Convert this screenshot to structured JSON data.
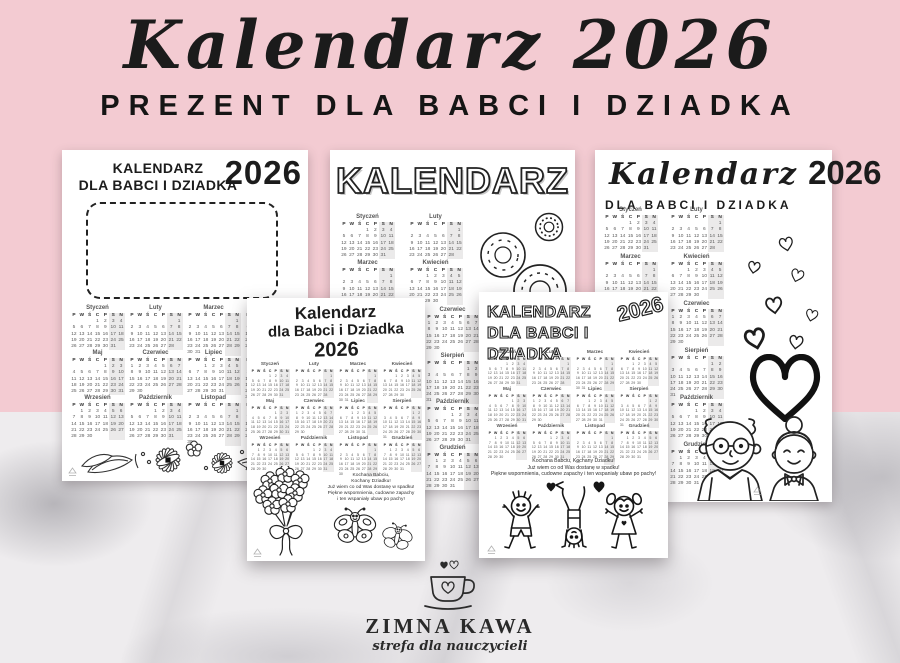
{
  "header": {
    "title": "Kalendarz 2026",
    "subtitle": "PREZENT DLA BABCI I DZIADKA"
  },
  "colors": {
    "pink": "#f3cbd2",
    "ink": "#1c1c1c",
    "weekend_shade": "#ebeaea",
    "marble": "#eeecee"
  },
  "calendar": {
    "year": "2026",
    "day_headers": [
      "P",
      "W",
      "Ś",
      "C",
      "P",
      "S",
      "N"
    ],
    "months": [
      {
        "name": "Styczeń",
        "start": 3,
        "days": 31
      },
      {
        "name": "Luty",
        "start": 6,
        "days": 28
      },
      {
        "name": "Marzec",
        "start": 6,
        "days": 31
      },
      {
        "name": "Kwiecień",
        "start": 2,
        "days": 30
      },
      {
        "name": "Maj",
        "start": 4,
        "days": 31
      },
      {
        "name": "Czerwiec",
        "start": 0,
        "days": 30
      },
      {
        "name": "Lipiec",
        "start": 2,
        "days": 31
      },
      {
        "name": "Sierpień",
        "start": 5,
        "days": 31
      },
      {
        "name": "Wrzesień",
        "start": 1,
        "days": 30
      },
      {
        "name": "Październik",
        "start": 3,
        "days": 31
      },
      {
        "name": "Listopad",
        "start": 6,
        "days": 30
      },
      {
        "name": "Grudzień",
        "start": 1,
        "days": 31
      }
    ]
  },
  "pages": {
    "page1": {
      "title_line1": "KALENDARZ",
      "title_line2": "DLA BABCI I DZIADKA",
      "year": "2026"
    },
    "page2": {
      "title": "KALENDARZ"
    },
    "page3": {
      "title_line1": "Kalendarz",
      "title_line2": "dla Babci i Dziadka",
      "year": "2026",
      "poem": [
        "Kochana Babciu,",
        "Kochany Dziadku!",
        "Już wiem co od Was dostanę w spadku!",
        "Piękne wspomnienia, cudowne zapachy",
        "i ten wspaniały ubaw po pachy!"
      ]
    },
    "page4": {
      "title_line1": "KALENDARZ",
      "title_line2": "DLA BABCI I DZIADKA",
      "year": "2026",
      "poem": [
        "Kochana Babciu, Kochany Dziadku!",
        "Już wiem co od Was dostanę w spadku!",
        "Piękne wspomnienia, cudowne zapachy i ten wspaniały ubaw po pachy!"
      ]
    },
    "page5": {
      "title_script": "Kalendarz",
      "year": "2026",
      "subtitle": "DLA BABCI I DZIADKA"
    }
  },
  "footer": {
    "brand": "ZIMNA KAWA",
    "tagline": "strefa dla nauczycieli"
  },
  "icons": {
    "flower_border": "flower-border-illustration",
    "donuts": "donuts-illustration",
    "bouquet": "flower-bouquet-illustration",
    "butterflies": "butterflies-illustration",
    "kids": "playing-kids-illustration",
    "hearts": "hearts-illustration",
    "big_heart": "big-heart-icon",
    "grandparents": "grandparents-illustration",
    "cup": "coffee-cup-heart-logo-icon",
    "watermark": "zimna-kawa-stamp-icon"
  }
}
